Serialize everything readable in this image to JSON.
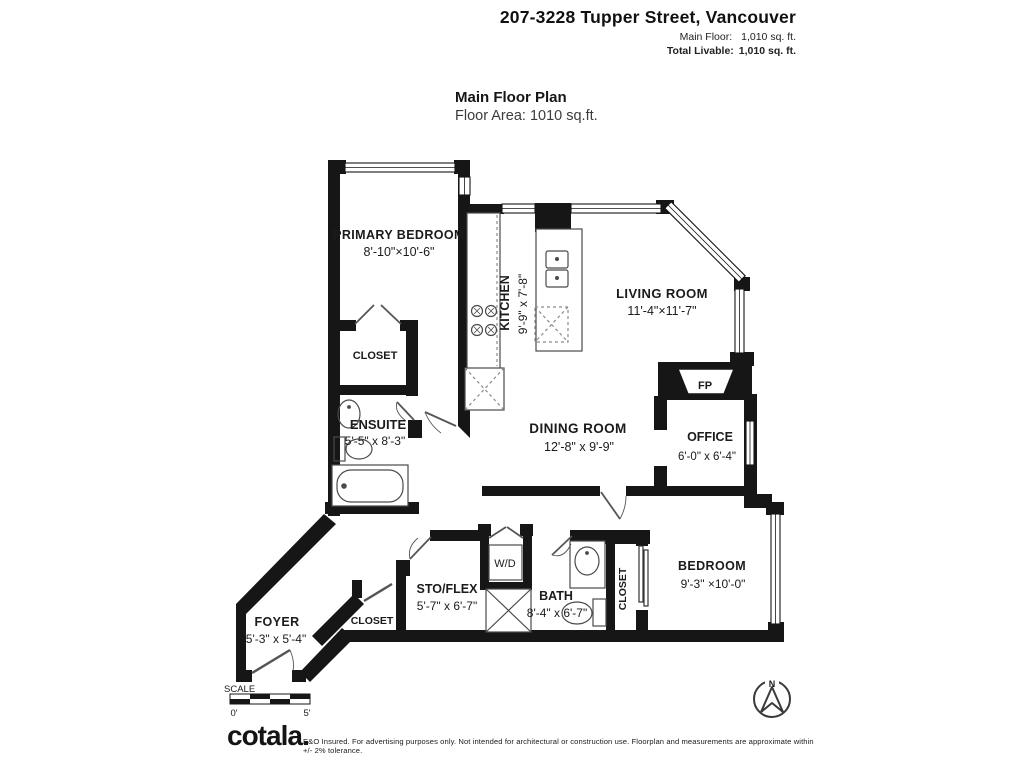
{
  "header": {
    "address": "207-3228 Tupper Street, Vancouver",
    "main_floor_label": "Main Floor:",
    "main_floor_value": "1,010 sq. ft.",
    "total_label": "Total Livable:",
    "total_value": "1,010 sq. ft."
  },
  "plan_title": {
    "title": "Main Floor Plan",
    "subtitle": "Floor Area: 1010 sq.ft."
  },
  "rooms": {
    "primary_bedroom": {
      "name": "PRIMARY BEDROOM",
      "dims": "8'-10\"×10'-6\""
    },
    "closet_primary": {
      "name": "CLOSET"
    },
    "ensuite": {
      "name": "ENSUITE",
      "dims": "5'-5\" x 8'-3\""
    },
    "kitchen": {
      "name": "KITCHEN",
      "dims": "9'-9\" x 7'-8\""
    },
    "living_room": {
      "name": "LIVING ROOM",
      "dims": "11'-4\"×11'-7\""
    },
    "dining_room": {
      "name": "DINING ROOM",
      "dims": "12'-8\" x 9'-9\""
    },
    "office": {
      "name": "OFFICE",
      "dims": "6'-0\" x 6'-4\""
    },
    "fireplace": {
      "name": "FP"
    },
    "sto_flex": {
      "name": "STO/FLEX",
      "dims": "5'-7\" x 6'-7\""
    },
    "laundry": {
      "name": "W/D"
    },
    "bath": {
      "name": "BATH",
      "dims": "8'-4\" x 6'-7\""
    },
    "closet_bedroom": {
      "name": "CLOSET"
    },
    "bedroom": {
      "name": "BEDROOM",
      "dims": "9'-3\" ×10'-0\""
    },
    "foyer": {
      "name": "FOYER",
      "dims": "5'-3\" x 5'-4\""
    },
    "closet_foyer": {
      "name": "CLOSET"
    }
  },
  "scale": {
    "label": "SCALE",
    "start": "0'",
    "end": "5'"
  },
  "compass": {
    "north": "N"
  },
  "footer": {
    "logo": "cotala",
    "disclaimer": "E&O Insured. For advertising purposes only. Not intended for architectural or construction use. Floorplan and measurements are approximate within +/- 2% tolerance."
  },
  "colors": {
    "wall": "#161616",
    "text": "#1b1b1b",
    "fixture": "#4a4a4a"
  }
}
